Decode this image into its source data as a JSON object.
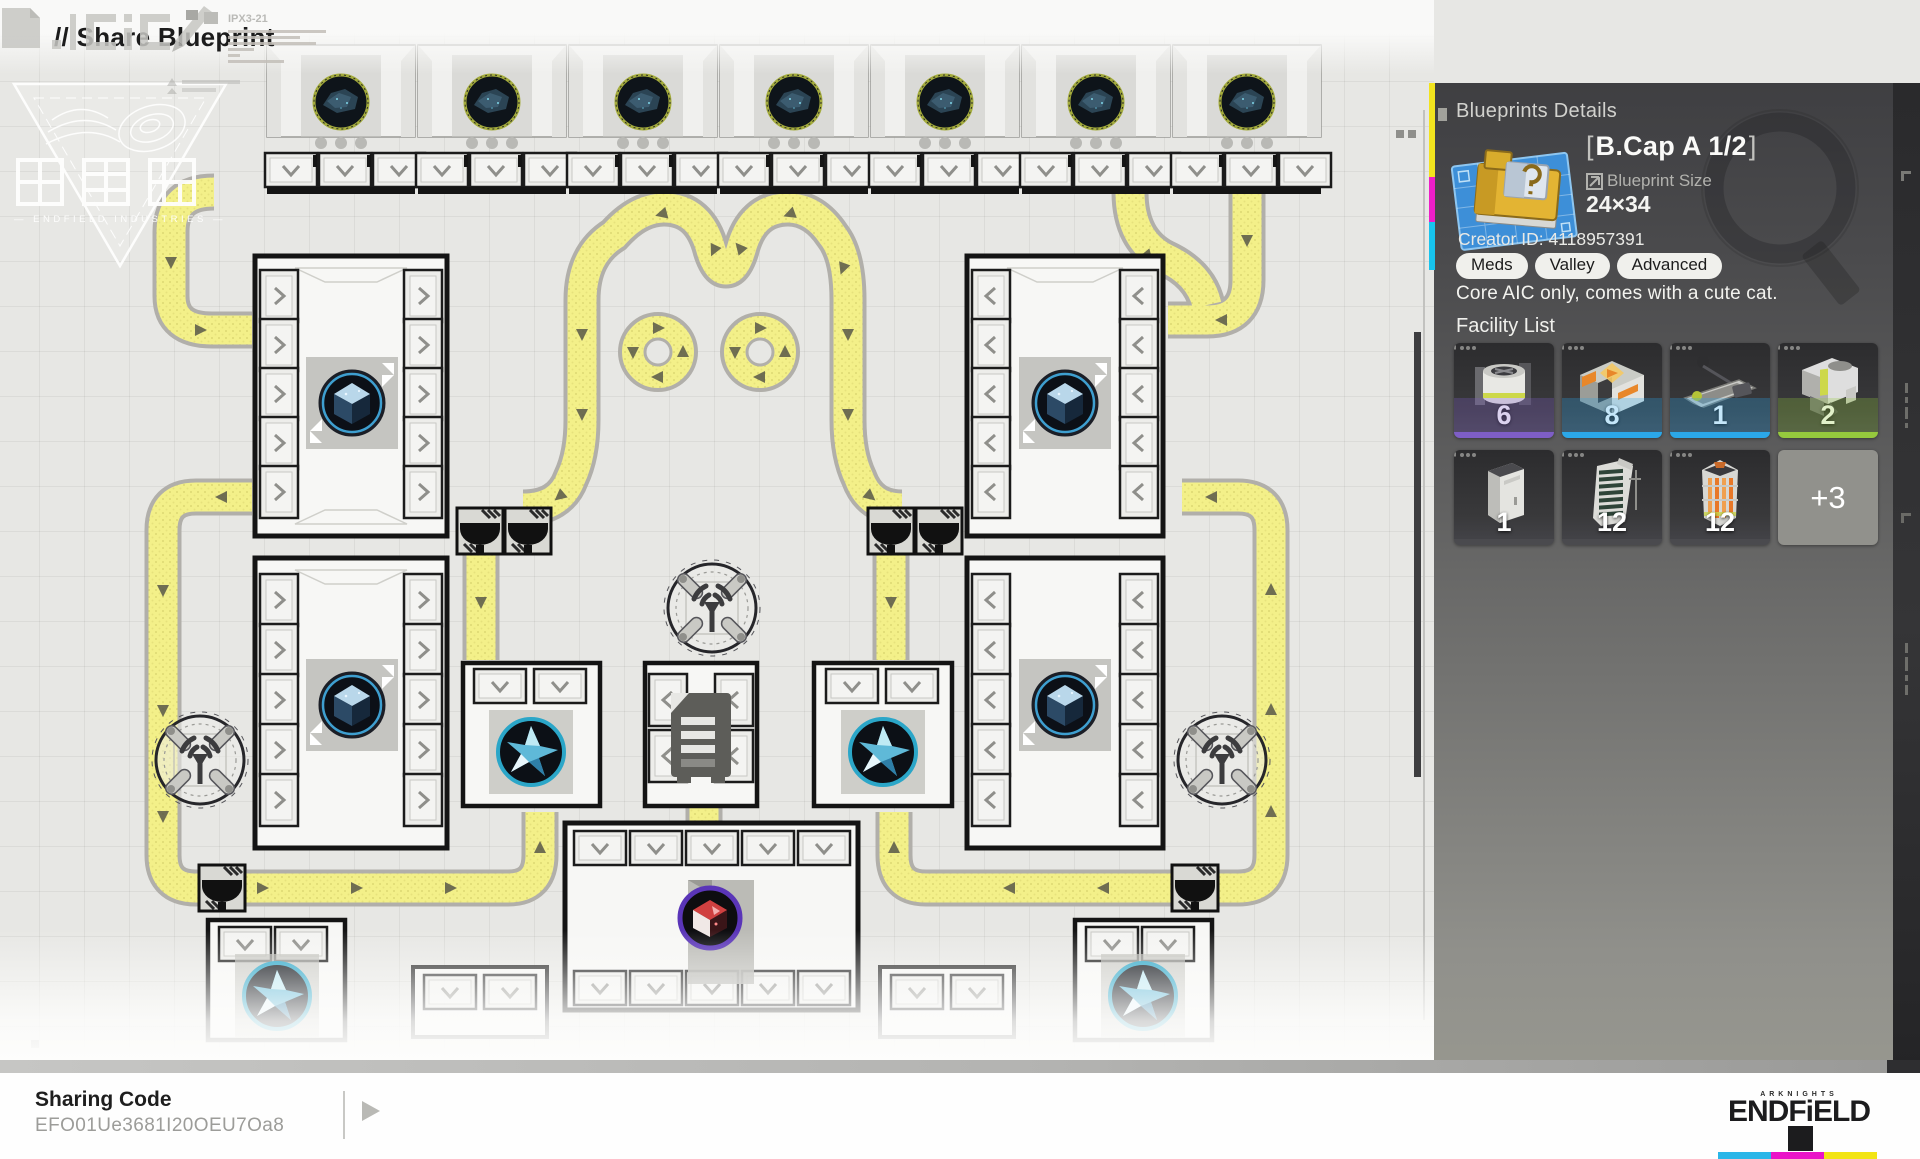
{
  "header": {
    "title": "// Share Blueprint"
  },
  "map": {
    "watermark_subtitle": "— ENDFIELD INDUSTRIES —",
    "deco_code": "IPX3-21"
  },
  "panel": {
    "section_title": "Blueprints Details",
    "item": {
      "bracket_left": "[",
      "title": "B.Cap A 1/2",
      "bracket_right": "]",
      "size_label": "Blueprint Size",
      "size_value": "24×34",
      "creator_label": "Creator ID:",
      "creator_value": "4118957391",
      "tags": [
        "Meds",
        "Valley",
        "Advanced"
      ],
      "description": "Core AIC only, comes with a cute cat."
    },
    "facility": {
      "heading": "Facility List",
      "items": [
        {
          "name": "mixer",
          "count": "6",
          "stripe": "#7e5ec6"
        },
        {
          "name": "smelter",
          "count": "8",
          "stripe": "#2ba7e8"
        },
        {
          "name": "press",
          "count": "1",
          "stripe": "#2ba7e8"
        },
        {
          "name": "hoist",
          "count": "2",
          "stripe": "#95c93d"
        },
        {
          "name": "cabinet",
          "count": "1",
          "stripe": "#4a4a4e"
        },
        {
          "name": "fin-tower",
          "count": "12",
          "stripe": "#4a4a4e"
        },
        {
          "name": "furnace",
          "count": "12",
          "stripe": "#4a4a4e"
        }
      ],
      "more_label": "+3"
    }
  },
  "footer": {
    "sharing_code_label": "Sharing Code",
    "sharing_code": "EFO01Ue3681I20OEU7Oa8",
    "brand_top": "ARKNIGHTS",
    "brand_name": "ENDFiELD",
    "brand_colors": [
      "#2ab6e8",
      "#ea14c8",
      "#f2e414"
    ]
  }
}
